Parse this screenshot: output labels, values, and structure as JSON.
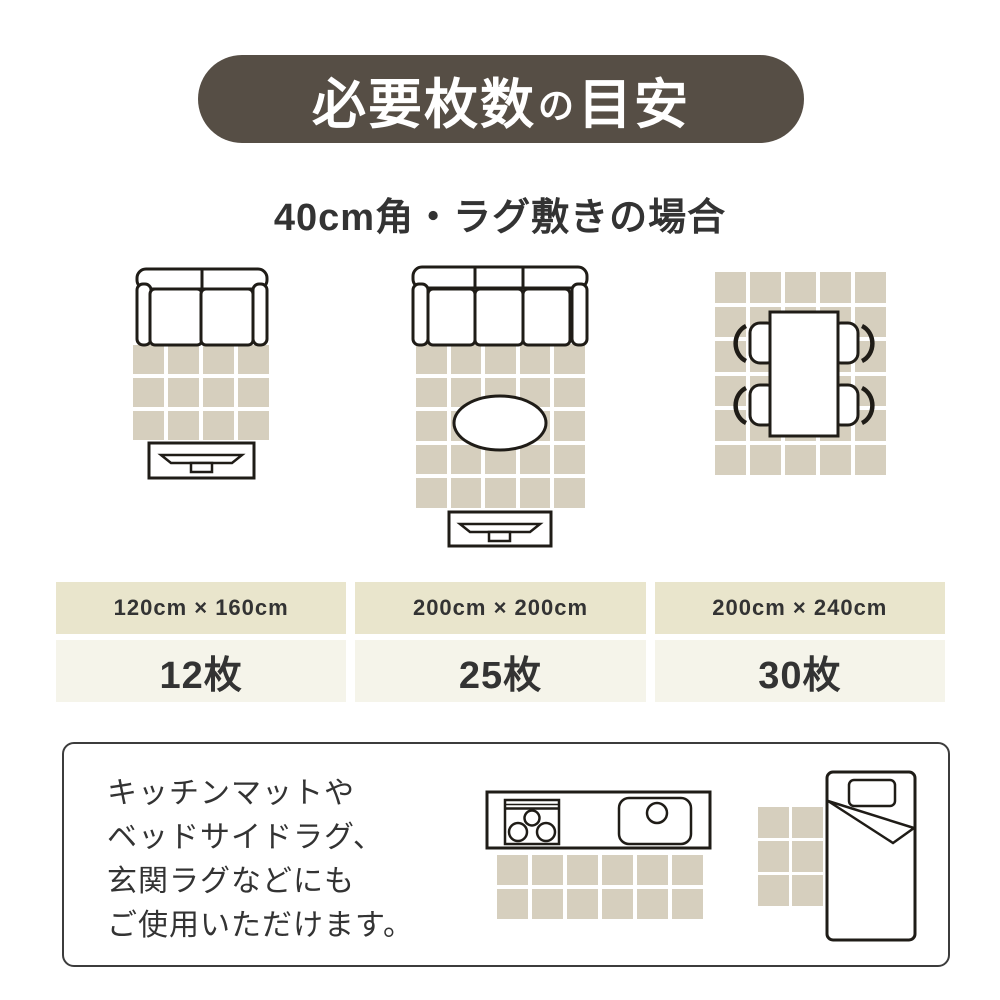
{
  "colors": {
    "pill_bg": "#564E45",
    "text_dark": "#333333",
    "tile": "#D6CFBE",
    "size_row_bg": "#E9E5CC",
    "count_row_bg": "#F5F4EA",
    "outline": "#1F1C17",
    "note_border": "#3C3C3C"
  },
  "header": {
    "title": "必要枚数の目安",
    "title_segments": {
      "part1": "必要枚数",
      "particle": "の",
      "part2": "目安"
    },
    "subtitle": "40cm角・ラグ敷きの場合"
  },
  "layouts": [
    {
      "illustration": "sofa-2seat-rug-tv-board",
      "grid": {
        "cols": 4,
        "rows": 3
      },
      "size": "120cm × 160cm",
      "count": "12枚"
    },
    {
      "illustration": "sofa-3seat-oval-table-rug-tv-board",
      "grid": {
        "cols": 5,
        "rows": 5
      },
      "size": "200cm × 200cm",
      "count": "25枚"
    },
    {
      "illustration": "dining-table-4-chairs-rug",
      "grid": {
        "cols": 5,
        "rows": 6
      },
      "size": "200cm × 240cm",
      "count": "30枚"
    }
  ],
  "note": {
    "lines": [
      "キッチンマットや",
      "ベッドサイドラグ、",
      "玄関ラグなどにも",
      "ご使用いただけます。"
    ],
    "illustrations": [
      {
        "id": "kitchen-mat",
        "grid": {
          "cols": 6,
          "rows": 2
        }
      },
      {
        "id": "bedside-rug",
        "grid": {
          "cols": 2,
          "rows": 3
        }
      }
    ]
  }
}
